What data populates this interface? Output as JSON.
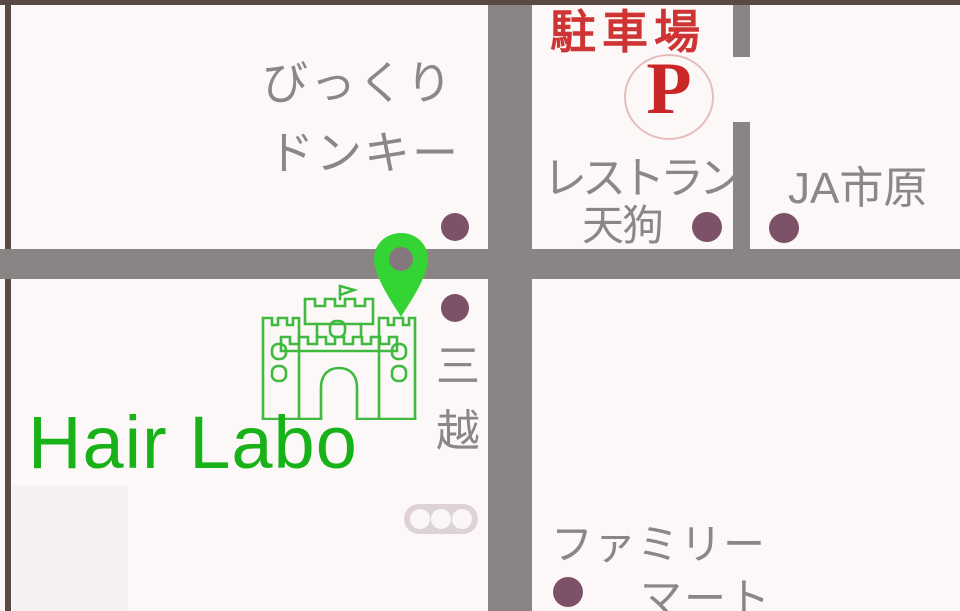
{
  "landmarks": {
    "bikkuri_donkey": {
      "line1": "びっくり",
      "line2": "ドンキー"
    },
    "parking": {
      "label": "駐車場",
      "symbol": "P"
    },
    "restaurant_tengu": {
      "line1": "レストラン",
      "line2": "天狗"
    },
    "ja_ichihara": {
      "label": "JA市原"
    },
    "mitsukoshi": {
      "char1": "三",
      "char2": "越"
    },
    "shop": {
      "name": "Hair Labo"
    },
    "family_mart": {
      "line1": "ファミリー",
      "line2": "マート"
    }
  },
  "icons": {
    "map_pin": "map-pin",
    "castle": "castle",
    "traffic_light": "traffic-light",
    "parking_symbol_circle": "parking-circle"
  },
  "markers": {
    "count": 5,
    "color": "#7d5269"
  },
  "colors": {
    "background": "#fbf8f7",
    "road": "#8a8485",
    "frame_border": "#594a46",
    "label_gray": "#8b8688",
    "parking_red": "#cf3434",
    "p_letter_red": "#c92727",
    "shop_green": "#18b218",
    "castle_green": "#3fba3f",
    "pin_green": "#34d434",
    "marker_plum": "#7d5269",
    "traffic_light_pink": "#ded2d4"
  }
}
